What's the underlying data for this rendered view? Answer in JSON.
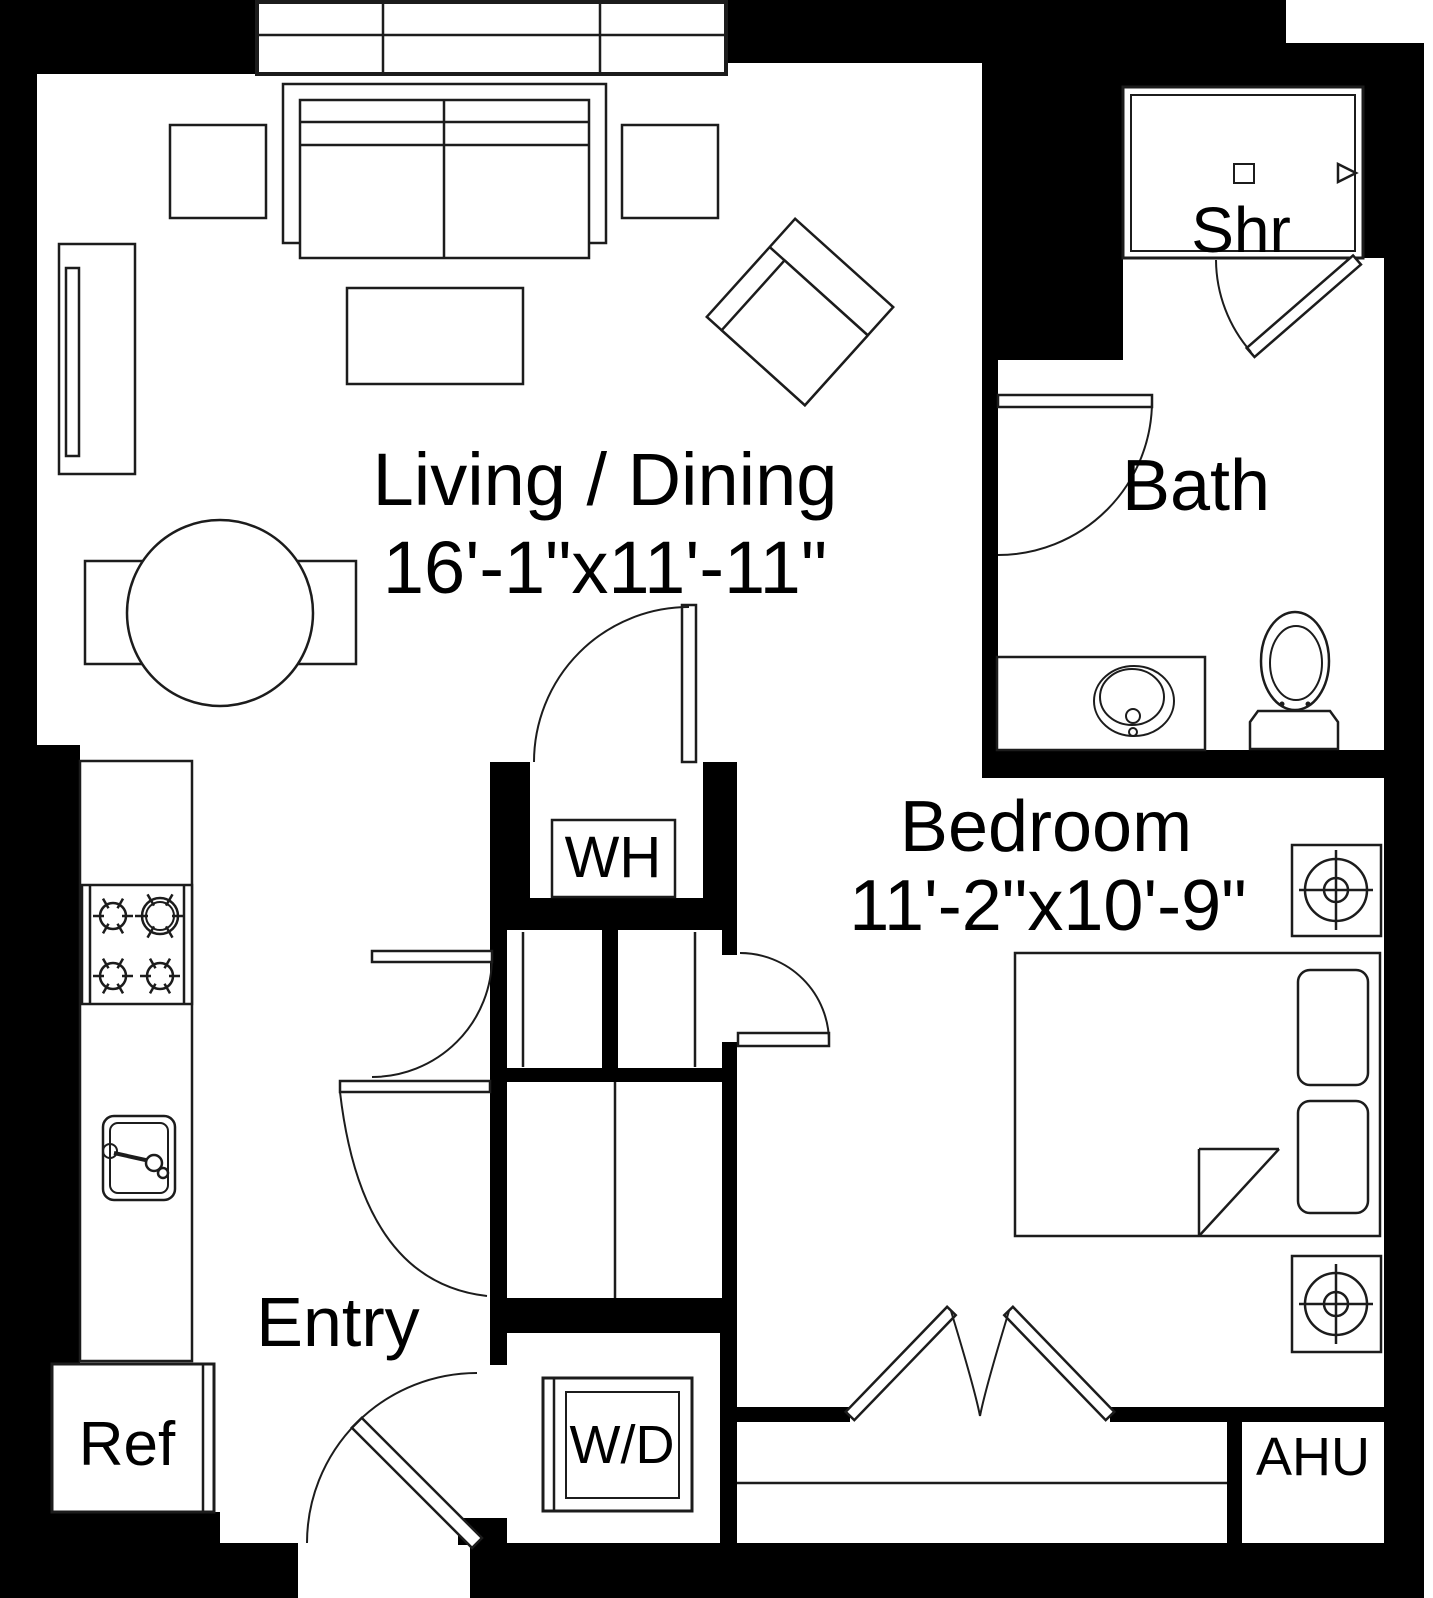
{
  "plan": {
    "title": "One-bedroom apartment floor plan",
    "rooms": {
      "living": {
        "name": "Living / Dining",
        "dims": "16'-1\"x11'-11\""
      },
      "bath": {
        "name": "Bath"
      },
      "bedroom": {
        "name": "Bedroom",
        "dims": "11'-2\"x10'-9\""
      },
      "entry": {
        "name": "Entry"
      }
    },
    "fixtures": {
      "shower": "Shr",
      "water_heater": "WH",
      "washer_dryer": "W/D",
      "refrigerator": "Ref",
      "air_handler": "AHU"
    },
    "colors": {
      "wall": "#000000",
      "line": "#1c1c1c",
      "floor": "#ffffff"
    }
  }
}
